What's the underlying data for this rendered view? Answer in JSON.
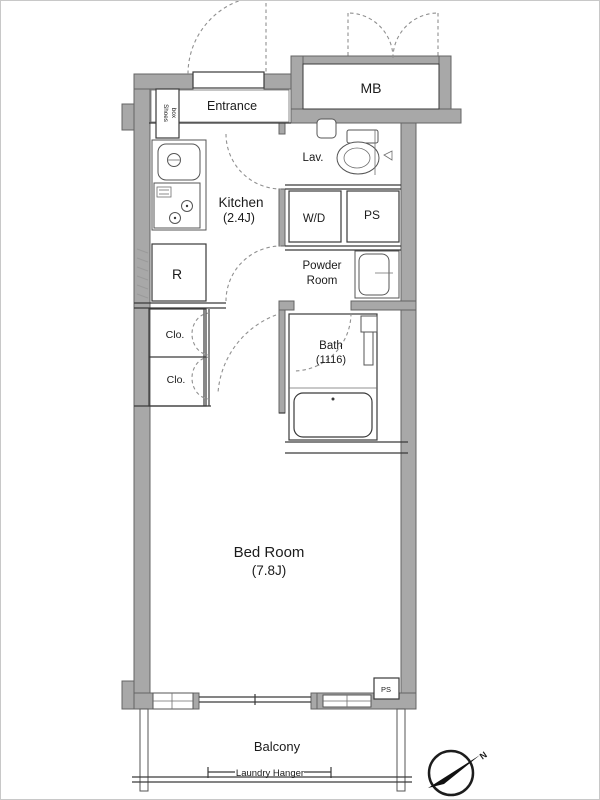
{
  "title": "apartment-floor-plan",
  "rooms": {
    "entrance": {
      "label": "Entrance"
    },
    "shoes_box": {
      "line1": "Shoes",
      "line2": "box"
    },
    "mb": {
      "label": "MB"
    },
    "kitchen": {
      "label": "Kitchen",
      "size": "(2.4J)"
    },
    "lavatory": {
      "label": "Lav."
    },
    "washer_dryer": {
      "label": "W/D"
    },
    "pipe_space": {
      "label": "PS"
    },
    "powder_room": {
      "line1": "Powder",
      "line2": "Room"
    },
    "refrigerator": {
      "label": "R"
    },
    "closet_upper": {
      "label": "Clo."
    },
    "closet_lower": {
      "label": "Clo."
    },
    "bath": {
      "label": "Bath",
      "size": "(1116)"
    },
    "bedroom": {
      "label": "Bed Room",
      "size": "(7.8J)"
    },
    "balcony": {
      "label": "Balcony"
    },
    "ps_shaft": {
      "label": "PS"
    }
  },
  "annotations": {
    "laundry_hanger": "Laundry Hanger",
    "north": "N"
  },
  "colors": {
    "wall_fill": "#a8a8a8",
    "wall_outline": "#646464",
    "line": "#3a3a3a",
    "door_dash": "#909090",
    "text": "#1b1b1b",
    "background": "#ffffff"
  }
}
